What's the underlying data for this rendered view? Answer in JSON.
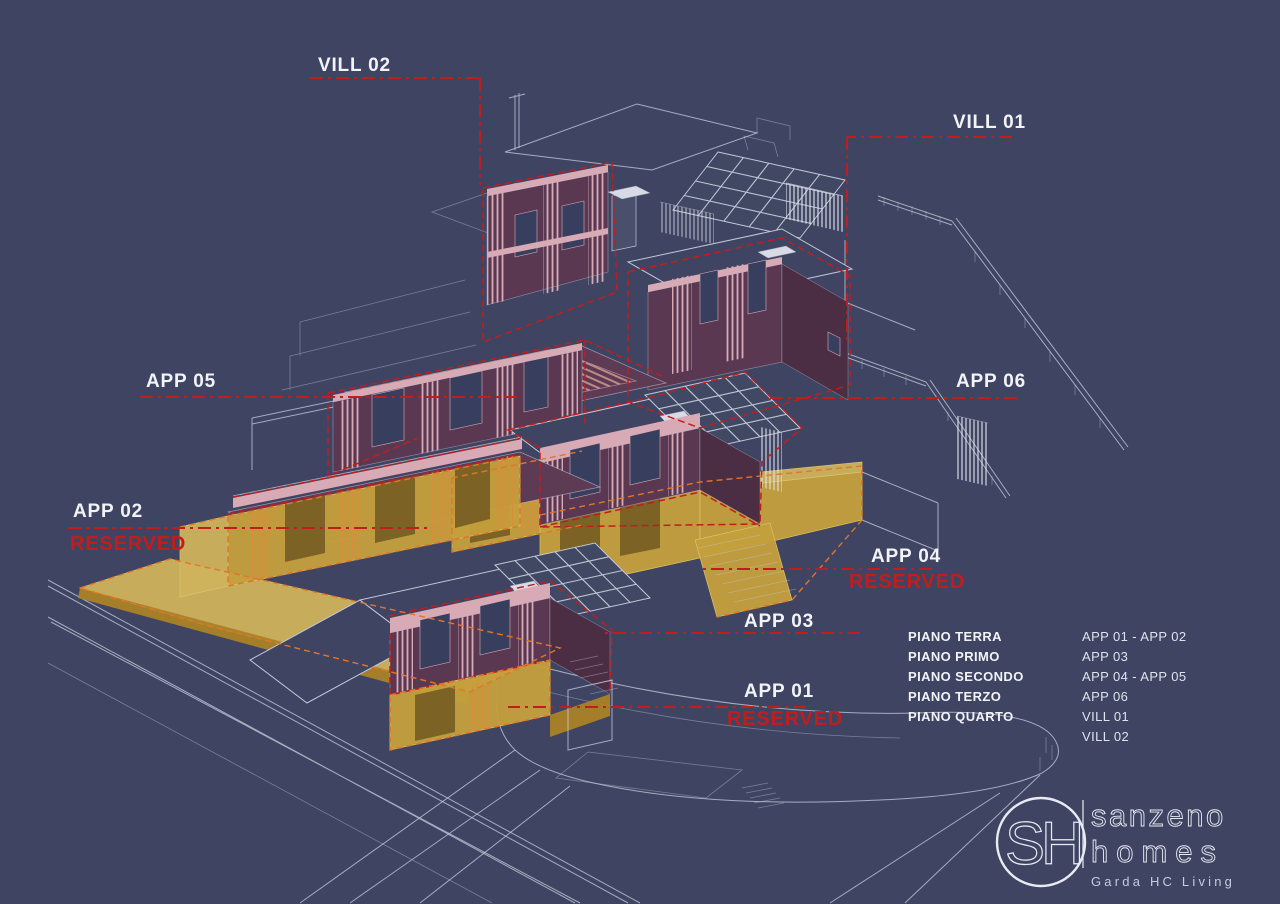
{
  "annotations": {
    "vill02": {
      "label": "VILL 02"
    },
    "vill01": {
      "label": "VILL 01"
    },
    "app05": {
      "label": "APP 05"
    },
    "app06": {
      "label": "APP 06"
    },
    "app02": {
      "label": "APP 02",
      "status": "RESERVED"
    },
    "app04": {
      "label": "APP 04",
      "status": "RESERVED"
    },
    "app03": {
      "label": "APP 03"
    },
    "app01": {
      "label": "APP 01",
      "status": "RESERVED"
    }
  },
  "legend": {
    "rows": [
      {
        "floor": "PIANO TERRA",
        "units": "APP 01 - APP 02"
      },
      {
        "floor": "PIANO PRIMO",
        "units": "APP 03"
      },
      {
        "floor": "PIANO SECONDO",
        "units": "APP 04 - APP 05"
      },
      {
        "floor": "PIANO TERZO",
        "units": "APP 06"
      },
      {
        "floor": "PIANO QUARTO",
        "units": "VILL 01"
      },
      {
        "floor": "",
        "units": "VILL 02"
      }
    ]
  },
  "logo": {
    "monogram": "SH",
    "brand_line1": "sanzeno",
    "brand_line2": "homes",
    "tagline": "Garda HC Living"
  },
  "colors": {
    "background": "#3e4462",
    "wireframe": "#c2c8d8",
    "maroon": "#5a3852",
    "pink": "#d8aab5",
    "yellow": "#c4a03c",
    "orange_dash": "#e0762a",
    "red_accent": "#c21d1d",
    "text": "#f2f3f7"
  }
}
